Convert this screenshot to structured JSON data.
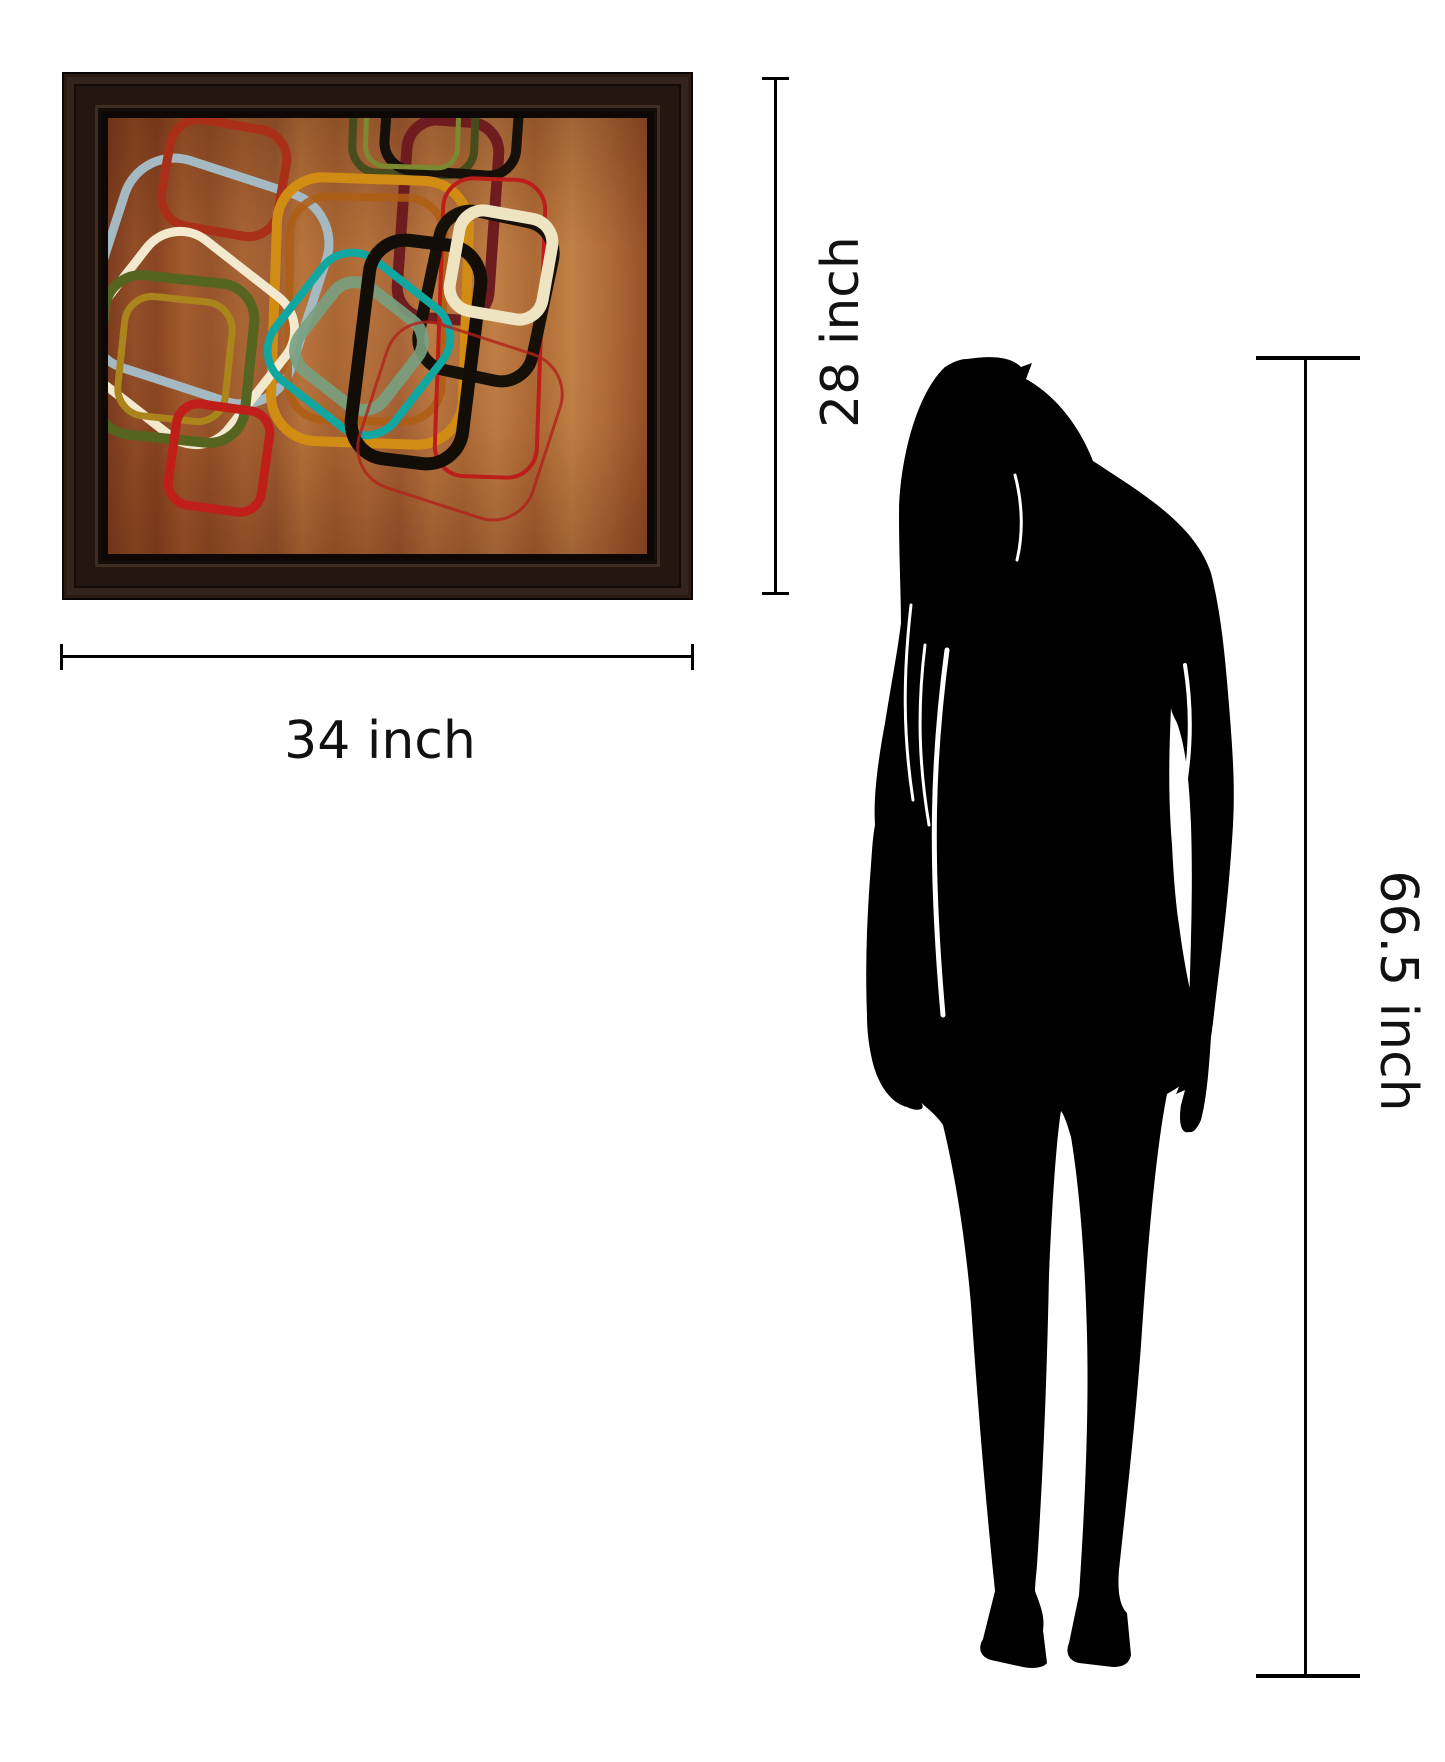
{
  "product": {
    "description": "Framed abstract wall art with retro rounded squares on rust-brown wood background",
    "frame_color": "#241711",
    "canvas_background": "#9a5228"
  },
  "dimensions": {
    "artwork_height_label": "28 inch",
    "artwork_width_label": "34 inch",
    "person_height_label": "66.5 inch",
    "line_color": "#000000",
    "label_color": "#111111"
  },
  "person": {
    "type": "woman-silhouette",
    "color": "#000000"
  },
  "artwork": {
    "palette": [
      "#a4b9c1",
      "#aa2f18",
      "#6e1c20",
      "#474c1d",
      "#7b8a32",
      "#d18c14",
      "#ae5e14",
      "#f2e9cf",
      "#55641e",
      "#ab851c",
      "#bd1e19",
      "#11a7a1",
      "#78a081",
      "#130d07",
      "#eee4c1",
      "#bf1f18"
    ],
    "shapes": [
      {
        "name": "bluegray-square",
        "cx": 100,
        "cy": 163,
        "w": 212,
        "h": 218,
        "r": 52,
        "rot": 18,
        "stroke": "#a4b9c1",
        "sw": 9
      },
      {
        "name": "red-square-top",
        "cx": 116,
        "cy": 60,
        "w": 118,
        "h": 108,
        "r": 30,
        "rot": 10,
        "stroke": "#aa2f18",
        "sw": 9
      },
      {
        "name": "maroon-tall-rect",
        "cx": 340,
        "cy": 102,
        "w": 92,
        "h": 198,
        "r": 30,
        "rot": 4,
        "stroke": "#6e1c20",
        "sw": 11
      },
      {
        "name": "darkolive-square-topright",
        "cx": 306,
        "cy": 8,
        "w": 122,
        "h": 96,
        "r": 26,
        "rot": 2,
        "stroke": "#474c1d",
        "sw": 8
      },
      {
        "name": "black-square-topright",
        "cx": 344,
        "cy": 4,
        "w": 132,
        "h": 102,
        "r": 28,
        "rot": 4,
        "stroke": "#16100a",
        "sw": 10
      },
      {
        "name": "green-line-topright",
        "cx": 304,
        "cy": 14,
        "w": 92,
        "h": 70,
        "r": 20,
        "rot": 2,
        "stroke": "#7b8a32",
        "sw": 5
      },
      {
        "name": "amber-rect",
        "cx": 262,
        "cy": 193,
        "w": 192,
        "h": 264,
        "r": 46,
        "rot": 2,
        "stroke": "#d18c14",
        "sw": 10
      },
      {
        "name": "orange-inner-rect",
        "cx": 258,
        "cy": 191,
        "w": 154,
        "h": 224,
        "r": 38,
        "rot": 1,
        "stroke": "#ae5e14",
        "sw": 8,
        "op": 0.85
      },
      {
        "name": "cream-square-left",
        "cx": 80,
        "cy": 220,
        "w": 176,
        "h": 176,
        "r": 42,
        "rot": 38,
        "stroke": "#f2e9cf",
        "sw": 9
      },
      {
        "name": "olive-square",
        "cx": 67,
        "cy": 241,
        "w": 150,
        "h": 160,
        "r": 36,
        "rot": 6,
        "stroke": "#55641e",
        "sw": 10
      },
      {
        "name": "gold-inner-square",
        "cx": 67,
        "cy": 241,
        "w": 108,
        "h": 120,
        "r": 28,
        "rot": 6,
        "stroke": "#ab851c",
        "sw": 7
      },
      {
        "name": "thin-red-rect-right",
        "cx": 382,
        "cy": 210,
        "w": 102,
        "h": 298,
        "r": 30,
        "rot": 2,
        "stroke": "#bd1e19",
        "sw": 4
      },
      {
        "name": "black-square-right",
        "cx": 378,
        "cy": 178,
        "w": 116,
        "h": 162,
        "r": 32,
        "rot": 12,
        "stroke": "#161008",
        "sw": 12
      },
      {
        "name": "teal-square",
        "cx": 251,
        "cy": 226,
        "w": 152,
        "h": 152,
        "r": 38,
        "rot": 38,
        "stroke": "#11a7a1",
        "sw": 8
      },
      {
        "name": "sage-inner-square",
        "cx": 251,
        "cy": 228,
        "w": 106,
        "h": 106,
        "r": 26,
        "rot": 38,
        "stroke": "#78a081",
        "sw": 12,
        "op": 0.9
      },
      {
        "name": "black-rect-center",
        "cx": 308,
        "cy": 234,
        "w": 112,
        "h": 220,
        "r": 36,
        "rot": 7,
        "stroke": "#130d07",
        "sw": 13
      },
      {
        "name": "cream-square-right",
        "cx": 393,
        "cy": 147,
        "w": 94,
        "h": 102,
        "r": 24,
        "rot": 10,
        "stroke": "#eee4c1",
        "sw": 12
      },
      {
        "name": "red-square-bottom",
        "cx": 111,
        "cy": 340,
        "w": 94,
        "h": 102,
        "r": 22,
        "rot": 8,
        "stroke": "#bf1f18",
        "sw": 9
      },
      {
        "name": "thin-red-diag-bottomright",
        "cx": 352,
        "cy": 303,
        "w": 182,
        "h": 172,
        "r": 42,
        "rot": 18,
        "stroke": "#b2221a",
        "sw": 3,
        "op": 0.8
      }
    ]
  }
}
